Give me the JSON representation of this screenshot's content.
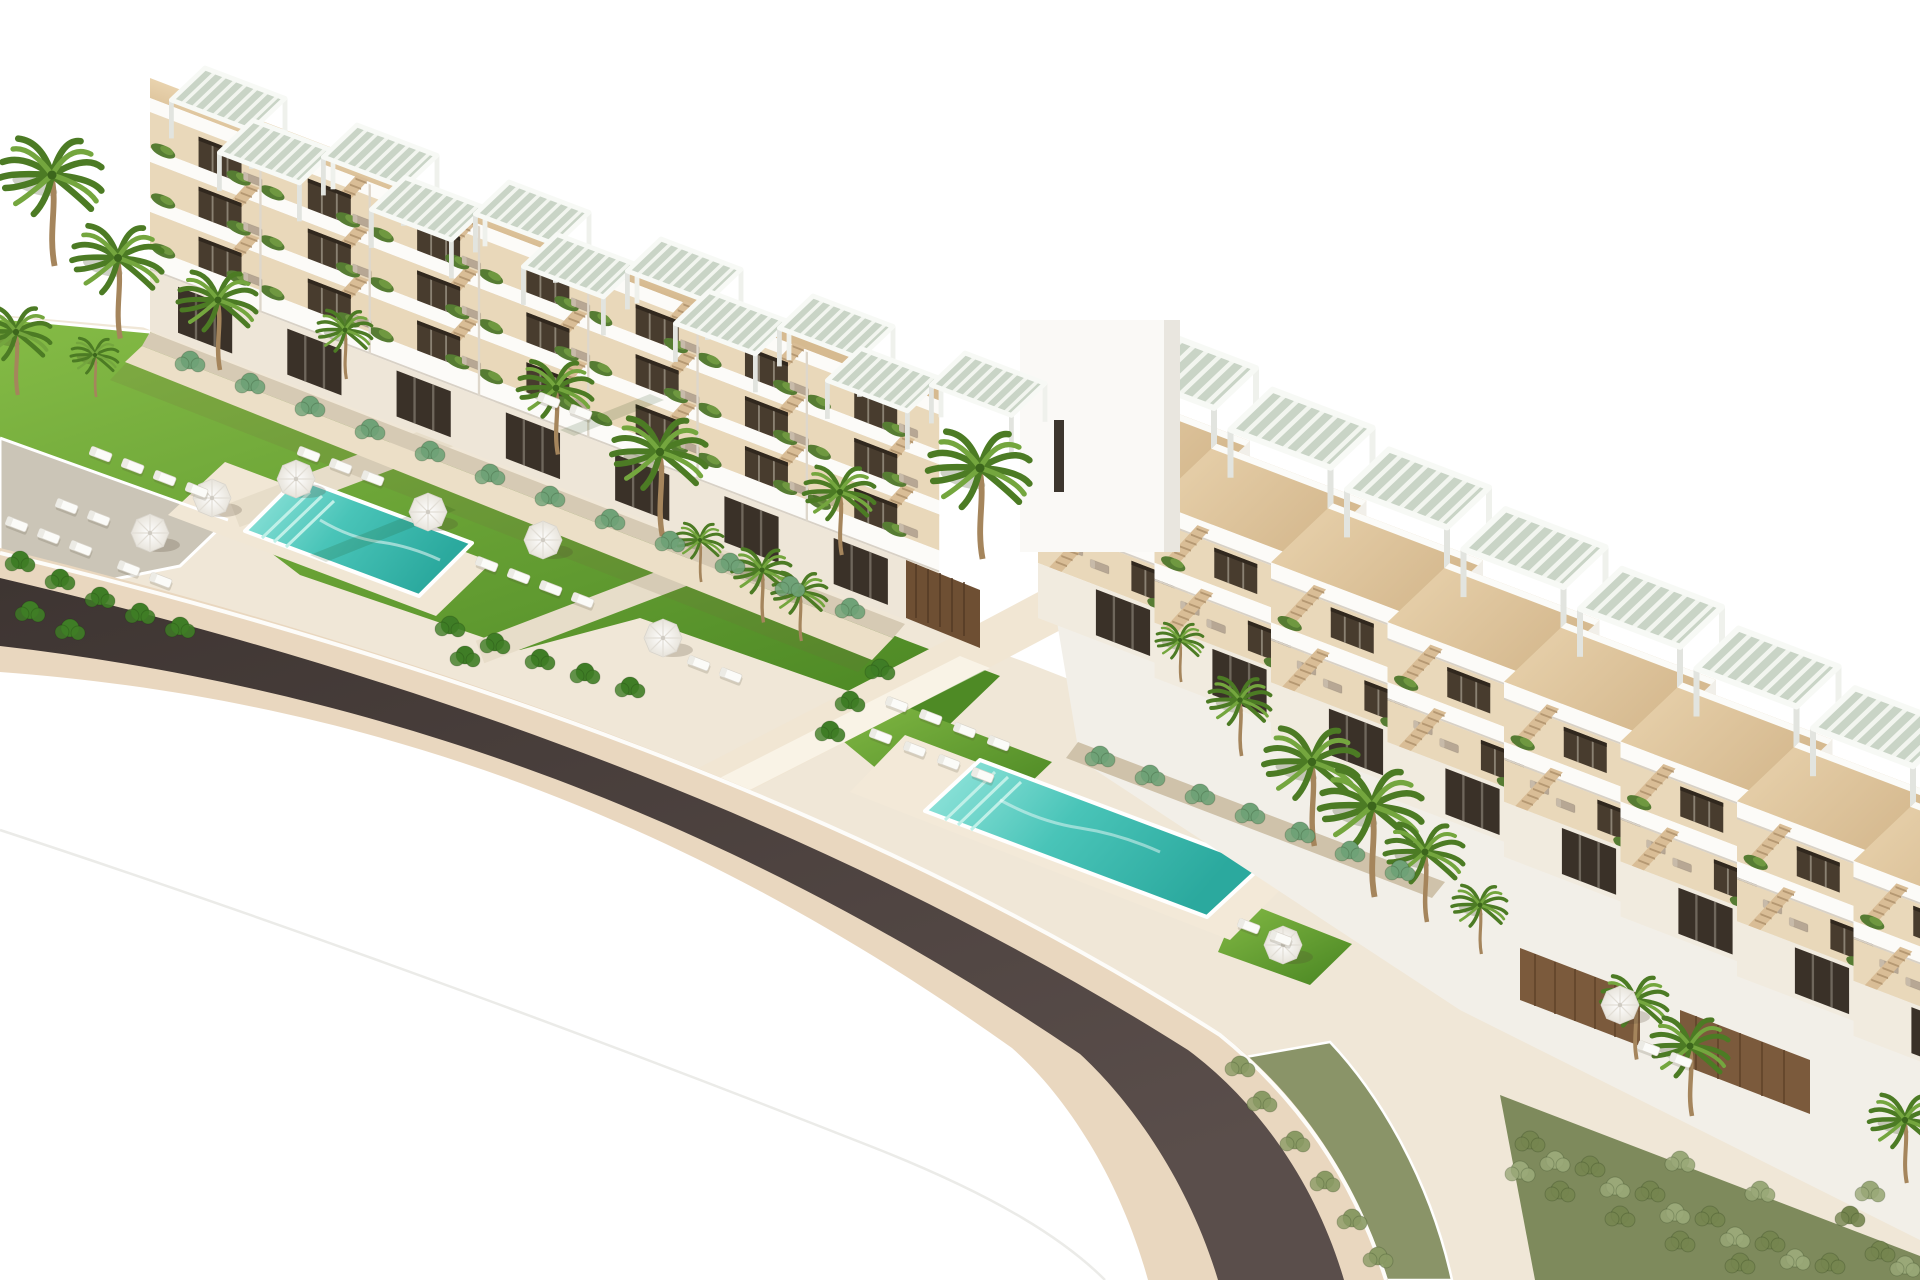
{
  "scene": {
    "type": "aerial 3D architectural rendering",
    "description": "Aerial rendering of a white terraced beachfront apartment complex: two stepped residential blocks with rooftop pergolas and wood sun decks, landscaped lawns, two turquoise swimming pools with white parasols and sun loungers, palm trees, planted borders, and a dark curved road sweeping past the resort on a white background."
  },
  "palette": {
    "sky": "#ffffff",
    "ground": "#f0e7d7",
    "curb": "#e9d7bf",
    "asphalt": "#453a37",
    "lawn-light": "#82b844",
    "lawn-dark": "#4e8a25",
    "pool-light": "#9ae8df",
    "pool-deep": "#2ba99e",
    "deck-wood": "#e0c9a5",
    "wall-white": "#f8f6f2",
    "terrace-recess": "#e9d8ba",
    "window-dark": "#463a2c",
    "slat-wood": "#7b5a3c",
    "stone-wall": "#d6cab4",
    "sand-path": "#ecdfc7",
    "palm-dark": "#4c7b24",
    "palm-light": "#74a63e",
    "trunk": "#a5855c",
    "umbrella": "#ffffff",
    "lounger-white": "#fbfbf8",
    "lounger-taupe": "#b7a794"
  },
  "inventory": {
    "buildings": 2,
    "stair-tower": 1,
    "swimming-pools": 2,
    "rooftop-pergolas": 19,
    "parasols": 8,
    "palm-trees": 22,
    "sun-loungers-lawn": 34,
    "road": 1
  },
  "stamps": [
    {
      "sym": "palm",
      "into": "layer-flora",
      "name": "palm-tree",
      "items": [
        [
          52,
          175,
          1.3
        ],
        [
          118,
          258,
          1.15
        ],
        [
          16,
          332,
          0.9
        ],
        [
          218,
          300,
          1
        ],
        [
          345,
          330,
          0.7
        ],
        [
          95,
          355,
          0.6
        ],
        [
          556,
          388,
          0.95
        ],
        [
          660,
          452,
          1.2
        ],
        [
          840,
          492,
          0.9
        ],
        [
          980,
          468,
          1.3
        ],
        [
          700,
          540,
          0.6
        ],
        [
          762,
          570,
          0.75
        ],
        [
          800,
          592,
          0.7
        ],
        [
          1180,
          640,
          0.6
        ],
        [
          1240,
          700,
          0.8
        ],
        [
          1312,
          762,
          1.2
        ],
        [
          1372,
          806,
          1.3
        ],
        [
          1425,
          852,
          1
        ],
        [
          1480,
          905,
          0.7
        ],
        [
          1635,
          1000,
          0.85
        ],
        [
          1690,
          1046,
          1
        ],
        [
          1905,
          1120,
          0.9
        ]
      ]
    },
    {
      "sym": "shrub",
      "into": "layer-flora",
      "name": "tropical-shrub",
      "cls": "trop",
      "items": [
        [
          20,
          560
        ],
        [
          60,
          578
        ],
        [
          100,
          596
        ],
        [
          140,
          612
        ],
        [
          180,
          626
        ],
        [
          30,
          610
        ],
        [
          70,
          628
        ],
        [
          450,
          625
        ],
        [
          495,
          642
        ],
        [
          540,
          658
        ],
        [
          585,
          672
        ],
        [
          630,
          686
        ],
        [
          465,
          655
        ],
        [
          850,
          700
        ],
        [
          830,
          730
        ],
        [
          880,
          668
        ]
      ]
    },
    {
      "sym": "shrub",
      "into": "layer-flora",
      "name": "agave-shrub",
      "cls": "agave",
      "items": [
        [
          190,
          360
        ],
        [
          310,
          405
        ],
        [
          430,
          450
        ],
        [
          550,
          495
        ],
        [
          670,
          540
        ],
        [
          790,
          585
        ],
        [
          250,
          382
        ],
        [
          370,
          428
        ],
        [
          490,
          473
        ],
        [
          610,
          518
        ],
        [
          730,
          562
        ],
        [
          850,
          607
        ],
        [
          1100,
          755
        ],
        [
          1150,
          774
        ],
        [
          1200,
          793
        ],
        [
          1250,
          812
        ],
        [
          1300,
          831
        ],
        [
          1350,
          850
        ],
        [
          1400,
          869
        ]
      ]
    },
    {
      "sym": "shrub",
      "into": "layer-flora",
      "name": "garden-shrub",
      "cls": "olive",
      "items": [
        [
          1530,
          1140
        ],
        [
          1590,
          1165
        ],
        [
          1650,
          1190
        ],
        [
          1710,
          1215
        ],
        [
          1770,
          1240
        ],
        [
          1830,
          1262
        ],
        [
          1560,
          1190
        ],
        [
          1620,
          1215
        ],
        [
          1680,
          1240
        ],
        [
          1740,
          1262
        ],
        [
          1880,
          1250
        ],
        [
          1850,
          1215
        ]
      ]
    },
    {
      "sym": "shrub",
      "into": "layer-flora",
      "name": "garden-shrub",
      "cls": "sage",
      "items": [
        [
          1555,
          1160
        ],
        [
          1615,
          1186
        ],
        [
          1675,
          1212
        ],
        [
          1735,
          1236
        ],
        [
          1795,
          1258
        ],
        [
          1870,
          1190
        ],
        [
          1520,
          1170
        ],
        [
          1905,
          1265
        ],
        [
          1680,
          1160
        ],
        [
          1760,
          1190
        ]
      ]
    },
    {
      "sym": "shrub",
      "into": "layer-flora",
      "name": "roadside-shrub",
      "cls": "roadside",
      "items": [
        [
          1262,
          1100
        ],
        [
          1295,
          1140
        ],
        [
          1325,
          1180
        ],
        [
          1352,
          1218
        ],
        [
          1378,
          1256
        ],
        [
          1240,
          1065
        ]
      ]
    },
    {
      "sym": "umbrella",
      "into": "layer-furniture",
      "name": "parasol",
      "items": [
        [
          150,
          533
        ],
        [
          212,
          498
        ],
        [
          296,
          479
        ],
        [
          428,
          512
        ],
        [
          543,
          540
        ],
        [
          663,
          638
        ],
        [
          1283,
          945
        ],
        [
          1620,
          1005
        ]
      ]
    },
    {
      "sym": "lngW",
      "into": "layer-furniture",
      "name": "sun-lounger",
      "items": [
        [
          58,
          498
        ],
        [
          90,
          510
        ],
        [
          540,
          392
        ],
        [
          572,
          404
        ],
        [
          300,
          446
        ],
        [
          332,
          458
        ],
        [
          364,
          470
        ],
        [
          92,
          446
        ],
        [
          124,
          458
        ],
        [
          156,
          470
        ],
        [
          188,
          482
        ],
        [
          8,
          516
        ],
        [
          40,
          528
        ],
        [
          72,
          540
        ],
        [
          478,
          556
        ],
        [
          510,
          568
        ],
        [
          542,
          580
        ],
        [
          574,
          592
        ],
        [
          120,
          560
        ],
        [
          152,
          572
        ],
        [
          888,
          696
        ],
        [
          922,
          709
        ],
        [
          956,
          722
        ],
        [
          990,
          735
        ],
        [
          872,
          728
        ],
        [
          906,
          741
        ],
        [
          940,
          754
        ],
        [
          974,
          767
        ],
        [
          1640,
          1040
        ],
        [
          1672,
          1052
        ],
        [
          690,
          655
        ],
        [
          722,
          667
        ],
        [
          1240,
          918
        ],
        [
          1272,
          930
        ]
      ]
    },
    {
      "sym": "stairL",
      "into": "gL",
      "name": "staircase",
      "start": [
        66,
        -82
      ],
      "step": [
        117,
        0
      ],
      "count": 7
    },
    {
      "sym": "stairL",
      "into": "gL",
      "name": "staircase",
      "start": [
        66,
        -132
      ],
      "step": [
        117,
        0
      ],
      "count": 7
    },
    {
      "sym": "stairL",
      "into": "gL",
      "name": "staircase",
      "start": [
        66,
        -182
      ],
      "step": [
        117,
        0
      ],
      "count": 7
    },
    {
      "sym": "winL",
      "into": "gL",
      "name": "terrace-door",
      "start": [
        52,
        -112
      ],
      "step": [
        117,
        0
      ],
      "count": 7
    },
    {
      "sym": "winL",
      "into": "gL",
      "name": "terrace-door",
      "start": [
        52,
        -162
      ],
      "step": [
        117,
        0
      ],
      "count": 7
    },
    {
      "sym": "winL",
      "into": "gL",
      "name": "terrace-door",
      "start": [
        52,
        -212
      ],
      "step": [
        117,
        0
      ],
      "count": 7
    },
    {
      "sym": "shopwin",
      "into": "gL",
      "name": "ground-floor-window",
      "start": [
        30,
        -54
      ],
      "step": [
        117,
        0
      ],
      "count": 7
    },
    {
      "sym": "planterL",
      "into": "gL",
      "name": "balcony-planter",
      "start": [
        14,
        -84
      ],
      "step": [
        117,
        0
      ],
      "count": 7
    },
    {
      "sym": "planterL",
      "into": "gL",
      "name": "balcony-planter",
      "start": [
        95,
        -86
      ],
      "step": [
        117,
        0
      ],
      "count": 7
    },
    {
      "sym": "planterL",
      "into": "gL",
      "name": "balcony-planter",
      "start": [
        14,
        -134
      ],
      "step": [
        117,
        0
      ],
      "count": 7
    },
    {
      "sym": "planterL",
      "into": "gL",
      "name": "balcony-planter",
      "start": [
        95,
        -136
      ],
      "step": [
        117,
        0
      ],
      "count": 7
    },
    {
      "sym": "planterL",
      "into": "gL",
      "name": "balcony-planter",
      "start": [
        14,
        -184
      ],
      "step": [
        117,
        0
      ],
      "count": 7
    },
    {
      "sym": "planterL",
      "into": "gL",
      "name": "balcony-planter",
      "start": [
        95,
        -186
      ],
      "step": [
        117,
        0
      ],
      "count": 7
    },
    {
      "sym": "lngT",
      "into": "gL",
      "name": "terrace-lounger",
      "start": [
        100,
        -94
      ],
      "step": [
        117,
        0
      ],
      "count": 7
    },
    {
      "sym": "lngT",
      "into": "gL",
      "name": "terrace-lounger",
      "start": [
        100,
        -144
      ],
      "step": [
        117,
        0
      ],
      "count": 7
    },
    {
      "sym": "lngT",
      "into": "gL",
      "name": "terrace-lounger",
      "start": [
        100,
        -194
      ],
      "step": [
        117,
        0
      ],
      "count": 7
    },
    {
      "sym": "divL",
      "into": "gL",
      "name": "unit-divider",
      "start": [
        117,
        -230
      ],
      "step": [
        117,
        0
      ],
      "count": 6
    },
    {
      "sym": "pergola",
      "into": "layer-roof-left",
      "name": "rooftop-pergola",
      "start": [
        205,
        68
      ],
      "step": [
        76,
        28.5
      ],
      "count": 11,
      "alt": [
        -28,
        24
      ],
      "scale": 0.8
    },
    {
      "sym": "unitR",
      "into": "layer-bldg-right",
      "name": "terraced-unit",
      "start": [
        1100,
        384
      ],
      "step": [
        116.5,
        59.7
      ],
      "count": 8
    }
  ]
}
